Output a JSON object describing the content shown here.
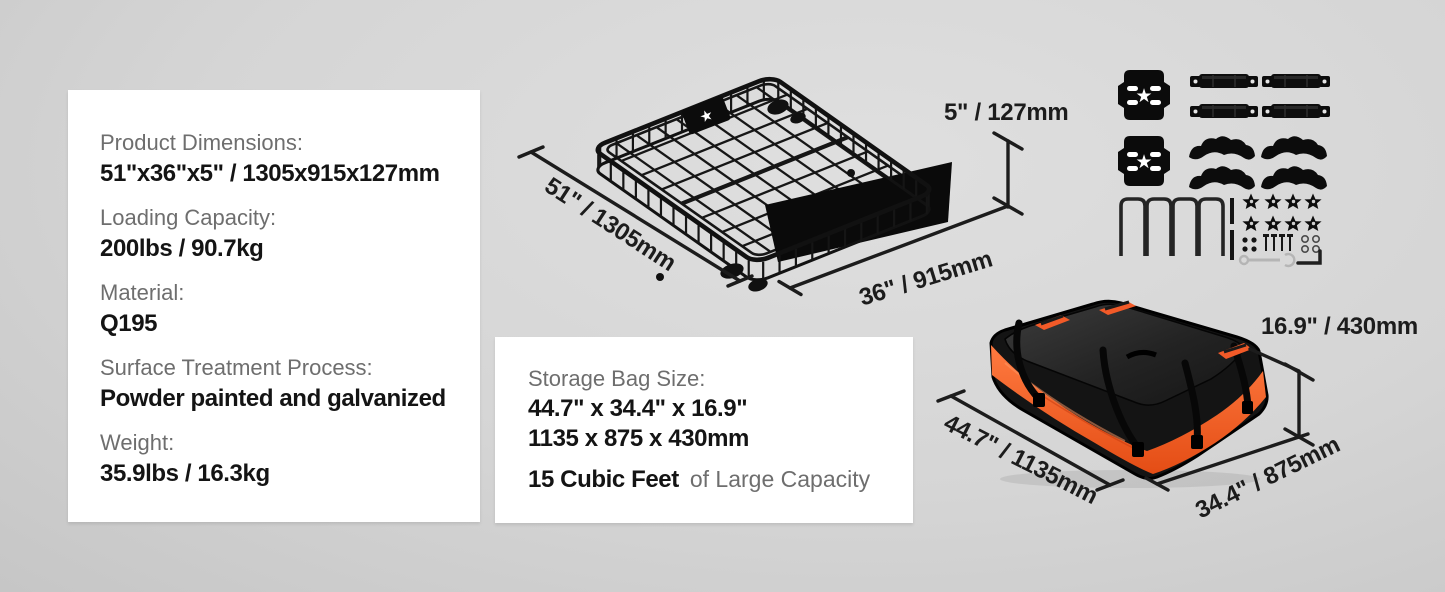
{
  "spec_card": {
    "items": [
      {
        "label": "Product Dimensions:",
        "value": "51\"x36\"x5\" / 1305x915x127mm"
      },
      {
        "label": "Loading Capacity:",
        "value": "200lbs / 90.7kg"
      },
      {
        "label": "Material:",
        "value": "Q195"
      },
      {
        "label": "Surface Treatment Process:",
        "value": "Powder painted and galvanized"
      },
      {
        "label": "Weight:",
        "value": "35.9lbs / 16.3kg"
      }
    ]
  },
  "bag_card": {
    "title": "Storage Bag Size:",
    "size_inches": "44.7\" x 34.4\" x 16.9\"",
    "size_mm": "1135 x 875 x 430mm",
    "capacity_bold": "15 Cubic Feet",
    "capacity_rest": "of  Large Capacity"
  },
  "dimensions": {
    "basket_length": "51\" / 1305mm",
    "basket_width": "36\" / 915mm",
    "basket_height": "5\" / 127mm",
    "bag_length": "44.7\" / 1135mm",
    "bag_width": "34.4\" / 875mm",
    "bag_height": "16.9\" / 430mm"
  },
  "illustrations": {
    "basket": "roof-rack-cargo-basket",
    "hardware": "mounting-hardware-kit",
    "bag": "waterproof-cargo-bag"
  },
  "colors": {
    "accent_orange": "#f0561f",
    "dimension_line": "#1c1c1c",
    "card_bg": "#ffffff",
    "label_gray": "#6e6e6e",
    "value_black": "#141414"
  }
}
